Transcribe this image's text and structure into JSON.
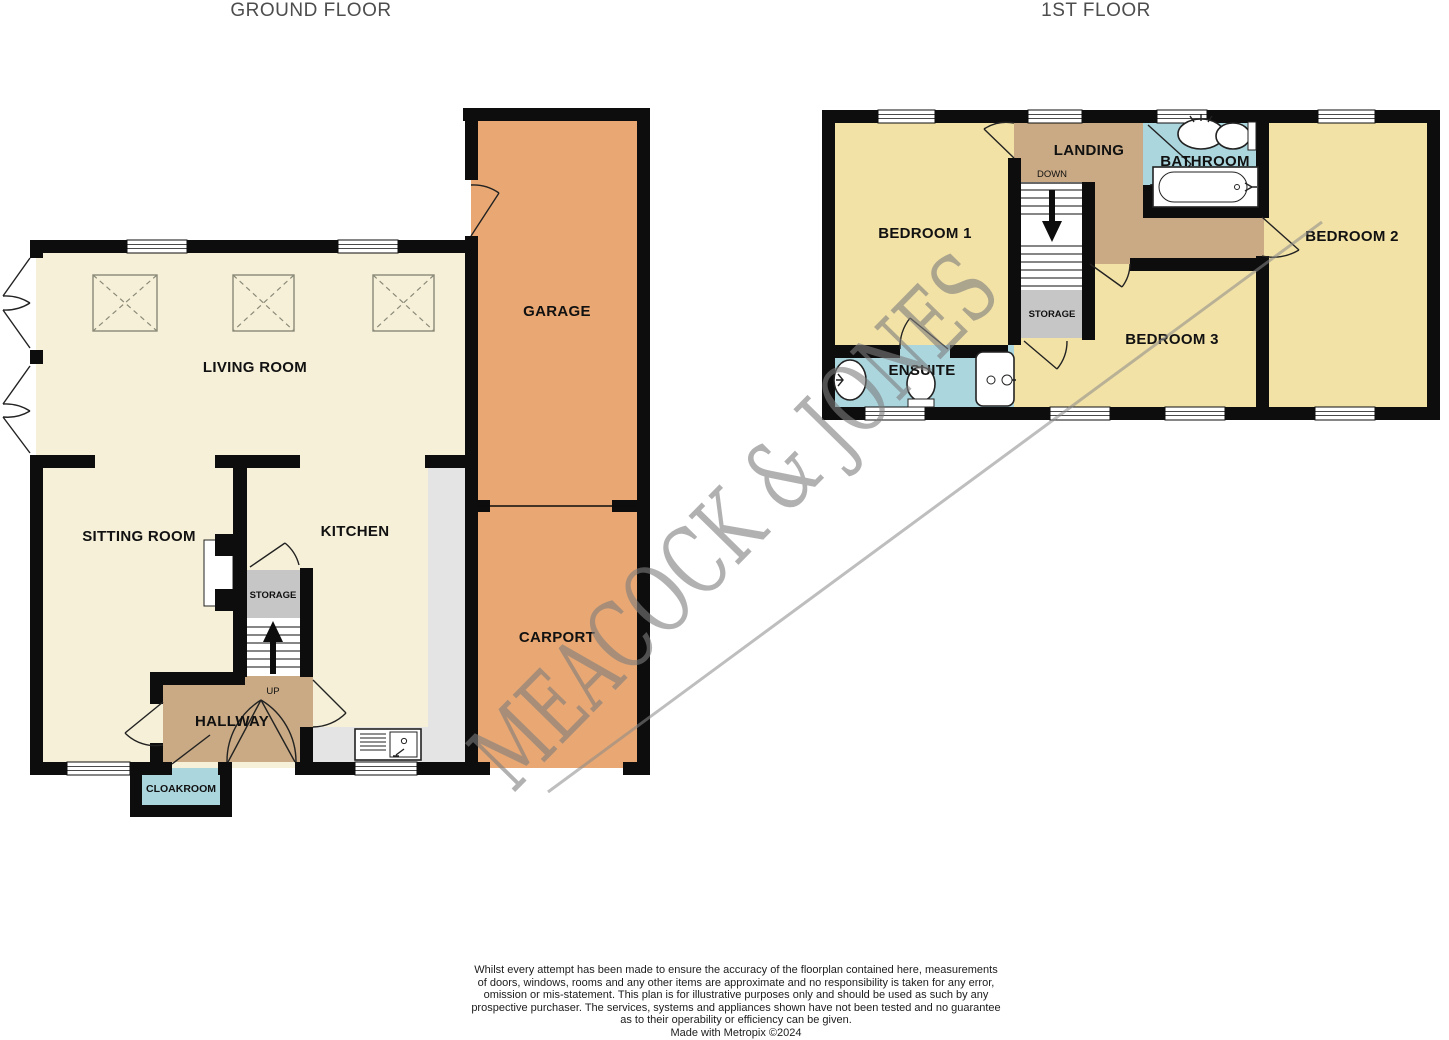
{
  "titles": {
    "ground_floor": "GROUND FLOOR",
    "first_floor": "1ST FLOOR"
  },
  "watermark_text": "MEACOCK & JONES",
  "ground_floor": {
    "living_room": "LIVING ROOM",
    "sitting_room": "SITTING ROOM",
    "kitchen": "KITCHEN",
    "garage": "GARAGE",
    "carport": "CARPORT",
    "hallway": "HALLWAY",
    "storage": "STORAGE",
    "cloakroom": "CLOAKROOM",
    "stairs_direction": "UP"
  },
  "first_floor": {
    "bedroom_1": "BEDROOM 1",
    "bedroom_2": "BEDROOM 2",
    "bedroom_3": "BEDROOM 3",
    "landing": "LANDING",
    "bathroom": "BATHROOM",
    "ensuite": "ENSUITE",
    "storage": "STORAGE",
    "stairs_direction": "DOWN"
  },
  "disclaimer": {
    "lines": [
      "Whilst every attempt has been made to ensure the accuracy of the floorplan contained here, measurements",
      "of doors, windows, rooms and any other items are approximate and no responsibility is taken for any error,",
      "omission or mis-statement. This plan is for illustrative purposes only and should be used as such by any",
      "prospective purchaser. The services, systems and appliances shown have not been tested and no guarantee",
      "as to their operability or efficiency can be given."
    ],
    "credit": "Made with Metropix ©2024"
  },
  "colors": {
    "room_cream": "#f6f0d8",
    "room_yellow": "#f3e2a6",
    "garage_orange": "#e9a873",
    "hall_tan": "#c9aa84",
    "wet_room_blue": "#abd6de",
    "storage_grey": "#c6c6c6",
    "counter_grey": "#e4e4e4",
    "wall_black": "#0d0d0d",
    "watermark_grey": "#7e7e7e",
    "title_grey": "#4d4d4d"
  }
}
